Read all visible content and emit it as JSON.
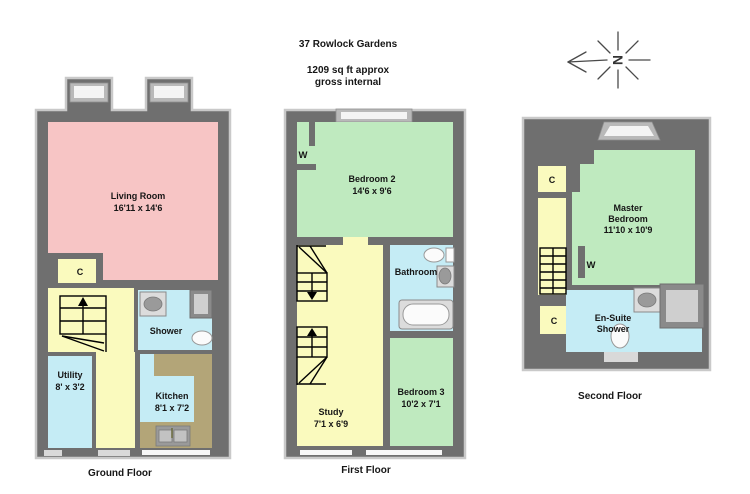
{
  "header": {
    "title": "37 Rowlock Gardens",
    "area_line1": "1209 sq ft approx",
    "area_line2": "gross internal"
  },
  "compass": {
    "north_letter": "N"
  },
  "colors": {
    "wall": "#6f6f6f",
    "wall_highlight": "#c9c9c9",
    "living": "#f7c5c5",
    "bedroom": "#bfeabf",
    "hall": "#fafabe",
    "wet_room": "#c5ecf5",
    "counter": "#b3a578",
    "window": "#f4f4f4"
  },
  "floors": {
    "ground": {
      "label": "Ground Floor",
      "rooms": {
        "living": {
          "name": "Living Room",
          "size": "16'11 x 14'6"
        },
        "shower": {
          "name": "Shower"
        },
        "utility": {
          "name": "Utility",
          "size": "8' x 3'2"
        },
        "kitchen": {
          "name": "Kitchen",
          "size": "8'1 x 7'2"
        },
        "cupboard": {
          "label": "C"
        }
      }
    },
    "first": {
      "label": "First Floor",
      "rooms": {
        "bedroom2": {
          "name": "Bedroom 2",
          "size": "14'6 x 9'6"
        },
        "bathroom": {
          "name": "Bathroom"
        },
        "bedroom3": {
          "name": "Bedroom 3",
          "size": "10'2 x 7'1"
        },
        "study": {
          "name": "Study",
          "size": "7'1 x 6'9"
        },
        "wardrobe": {
          "label": "W"
        }
      }
    },
    "second": {
      "label": "Second Floor",
      "rooms": {
        "master": {
          "name_line1": "Master",
          "name_line2": "Bedroom",
          "size": "11'10 x 10'9"
        },
        "ensuite": {
          "name_line1": "En-Suite",
          "name_line2": "Shower"
        },
        "cupboard_upper": {
          "label": "C"
        },
        "cupboard_lower": {
          "label": "C"
        },
        "wardrobe": {
          "label": "W"
        }
      }
    }
  }
}
